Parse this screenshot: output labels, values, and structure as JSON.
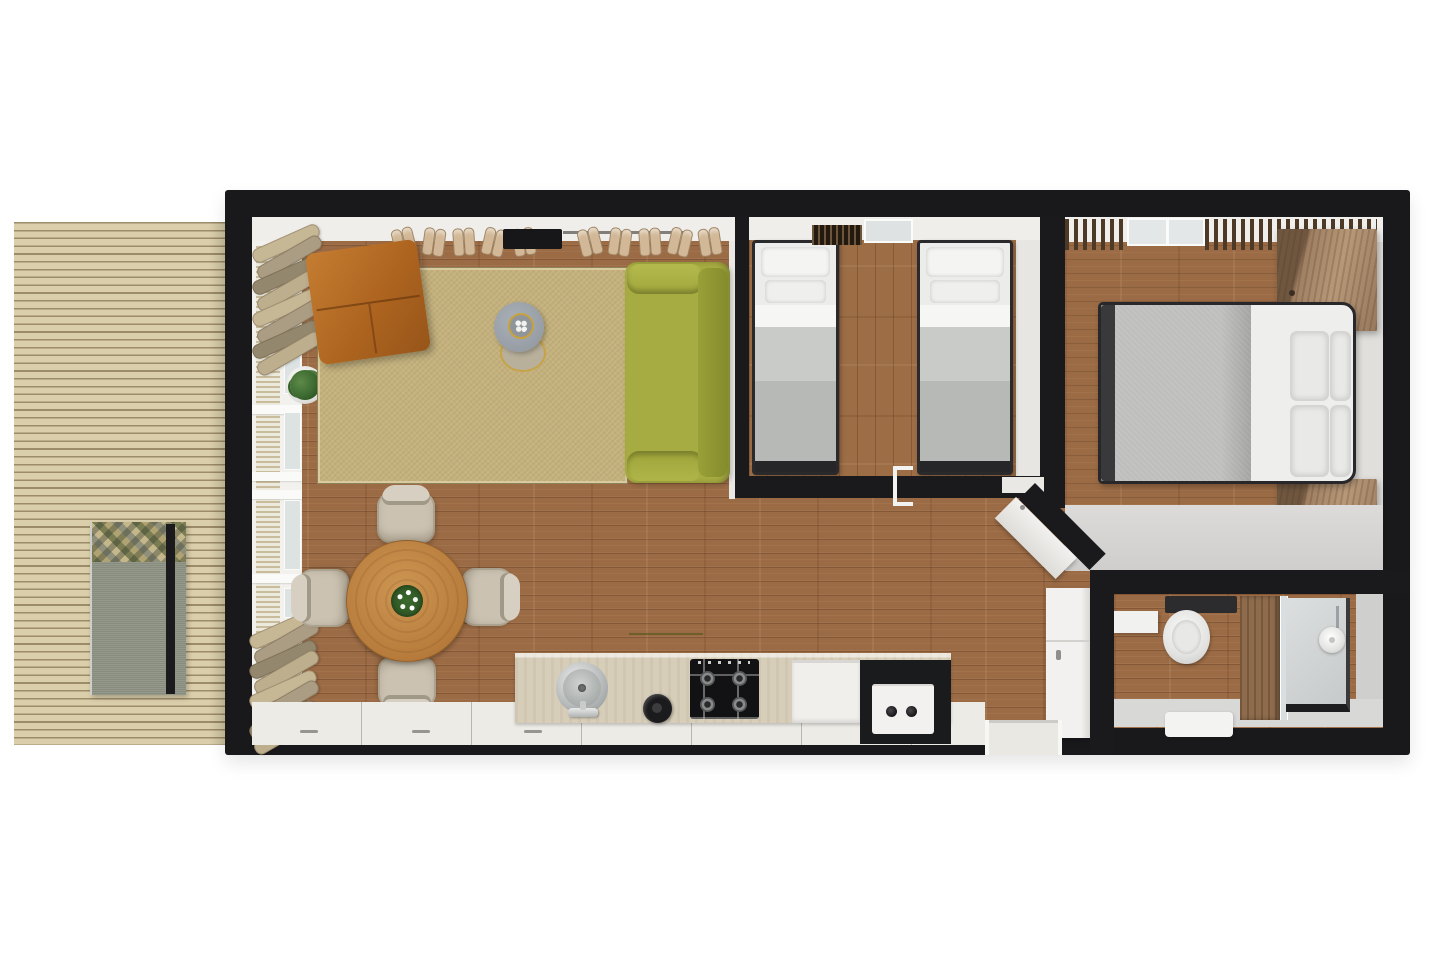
{
  "title": "Holiday home floor plan — 3D top-down view",
  "palette": {
    "wall": "#1a1a1c",
    "floor_wood": "#9b6b45",
    "deck_wood": "#dbcfab",
    "interior_face_white": "#efeeeb",
    "interior_face_gray": "#d6d5d3",
    "rug_sisal": "#c4b17c",
    "sofa_green": "#a7ac42",
    "ottoman_leather": "#b4661f",
    "dining_table_wood": "#c08a4a",
    "chair_fabric": "#cbc2b2",
    "counter_stone": "#d7ceba",
    "appliance_white": "#f1f0ed",
    "appliance_black": "#1a1b1c",
    "bed_blanket_gray": "#c3c5c3",
    "bed_linen_white": "#f3f3f1",
    "nightstand_wood": "#a98a69",
    "slat_wood": "#4c3a26",
    "window_glass": "#dfe3e3",
    "plant_green": "#3c6a2e",
    "lounger_gray": "#8e9486"
  },
  "rooms": {
    "deck": {
      "label": "Outdoor wooden deck",
      "furniture": [
        "slatted decking",
        "gray lounger bench with mosaic-pattern cushion"
      ]
    },
    "living": {
      "label": "Open-plan living room",
      "furniture": [
        "sisal area rug",
        "cognac leather ottoman",
        "olive-green two-seat sofa",
        "round gray coffee table with gold tray",
        "nesting side table",
        "potted plant",
        "two firewood stacks by the window wall",
        "wall rack with slippers",
        "black wall console"
      ]
    },
    "dining": {
      "label": "Dining area",
      "furniture": [
        "round wooden table",
        "white flower centerpiece",
        "four beige upholstered chairs"
      ]
    },
    "kitchen": {
      "label": "Kitchen along the bottom wall",
      "furniture": [
        "stone countertop",
        "round stainless sink with faucet",
        "black kettle",
        "four-burner gas hob",
        "white dishwasher",
        "washing machine in black module"
      ]
    },
    "twin_bedroom": {
      "label": "Twin bedroom",
      "furniture": [
        "single bed with two pillows",
        "single bed with two pillows",
        "slatted radiator shelf",
        "window",
        "door opening"
      ]
    },
    "master_bedroom": {
      "label": "Master bedroom",
      "furniture": [
        "double bed with four pillows",
        "wooden nightstand",
        "wooden nightstand",
        "slatted canopy strips",
        "window"
      ]
    },
    "bathroom": {
      "label": "Bathroom",
      "furniture": [
        "wall-hung toilet with cistern",
        "vanity shelf",
        "glass shower with wooden cabinet and rain head",
        "white bath mat"
      ]
    },
    "hall": {
      "label": "Entry hall",
      "furniture": [
        "entrance threshold",
        "open hall door",
        "open diagonal bedroom door"
      ]
    }
  }
}
